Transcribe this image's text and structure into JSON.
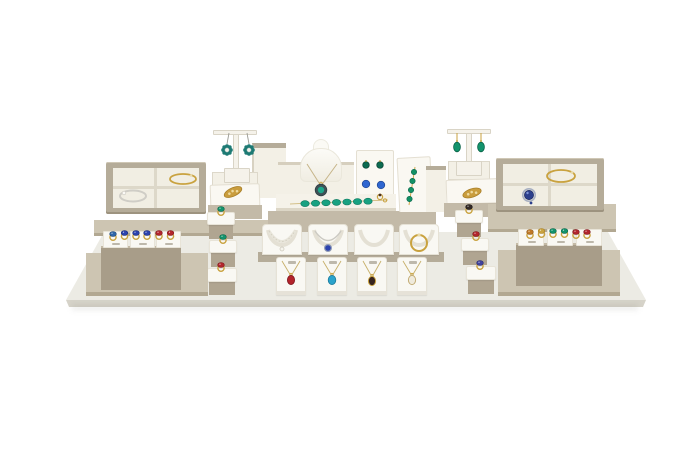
{
  "scene": {
    "description": "Product photograph of a beige and cream jewelry retail display set arranged on a large white display base against a pure white background",
    "background": "#ffffff"
  },
  "palette": {
    "base_top": "#ecebe4",
    "base_front": "#d6d3c9",
    "plat": "#c3baa8",
    "plat_light": "#cdc5b2",
    "plat_dark": "#a89d89",
    "tray_border": "#b5ac99",
    "tray_inner": "#f1eee3",
    "divider": "#ddd8c9",
    "card": "#f9f8f3",
    "cream": "#f3f0e6",
    "white_disp": "#faf8f2",
    "gold": "#c9a23f",
    "gold_dark": "#a87e26",
    "silver": "#cfcdc6",
    "emerald": "#13936c",
    "teal": "#1d7a74",
    "sapphire": "#2c43ae",
    "ruby": "#b3262c",
    "turquoise": "#2ba3cc",
    "onyx": "#332a26",
    "amber": "#c07a28",
    "tag": "#bdb8ab"
  },
  "display": {
    "base": "white rectangular display base board",
    "left_tray": {
      "compartments": 4,
      "items": [
        "silver bracelet with pearl",
        "gold bangle"
      ]
    },
    "right_tray": {
      "compartments": 4,
      "items": [
        "gold bangle",
        "sapphire halo brooch"
      ]
    },
    "left_earring_stand": {
      "type": "T-bar stand",
      "items": [
        "pair of teal flower earrings with pearl centers"
      ]
    },
    "right_earring_stand": {
      "type": "T-bar stand",
      "items": [
        "pair of emerald drop earrings"
      ]
    },
    "left_brooch_slab": {
      "items": [
        "gold leaf brooch"
      ]
    },
    "right_brooch_slab": {
      "items": [
        "gold leaf brooch"
      ]
    },
    "necklace_bust": {
      "items": [
        "emerald halo pendant necklace on chain"
      ]
    },
    "earring_card": {
      "items": [
        "emerald stud earrings",
        "sapphire stud earrings",
        "gold ring"
      ]
    },
    "bracelet_bar": {
      "items": [
        "emerald cabochon line bracelet with gold chain"
      ]
    },
    "slant_stand": {
      "items": [
        "emerald station bracelet on gold chain"
      ]
    },
    "left_ring_column": {
      "items": [
        "emerald ring",
        "emerald ring",
        "ruby ring"
      ]
    },
    "right_ring_column": {
      "items": [
        "onyx ring",
        "ruby ring",
        "blue-violet ring"
      ]
    },
    "left_ring_block": {
      "items": [
        "blue ring",
        "sapphire ring",
        "sapphire ring",
        "sapphire ring",
        "ruby ring",
        "ruby ring"
      ]
    },
    "right_ring_block": {
      "items": [
        "amber ring",
        "gold ring",
        "emerald ring",
        "emerald ring",
        "ruby ring",
        "ruby ring"
      ]
    },
    "collar_displays": {
      "items": [
        "pearl necklace",
        "sapphire pendant choker",
        "empty collar form",
        "gold round bangle"
      ]
    },
    "pendant_stands": {
      "items": [
        "ruby pendant necklace",
        "turquoise pendant necklace",
        "garnet pendant necklace",
        "opal pendant necklace"
      ]
    }
  }
}
